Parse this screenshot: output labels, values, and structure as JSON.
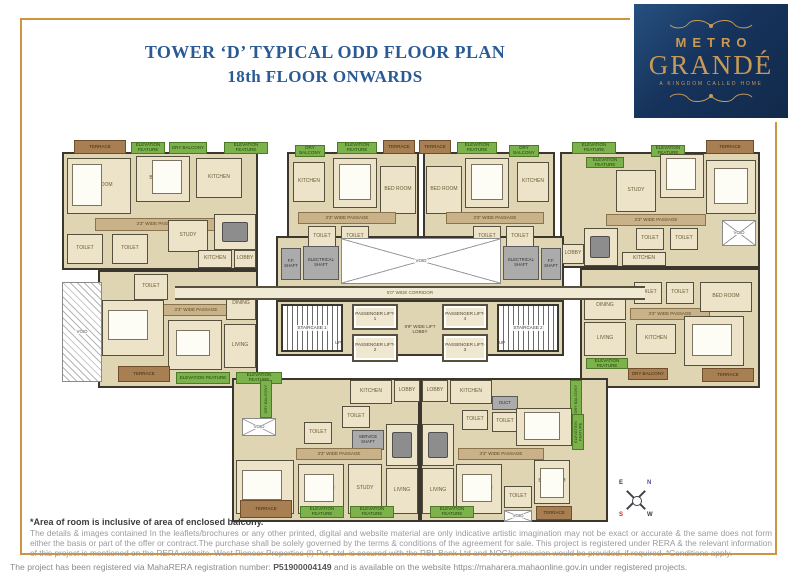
{
  "header": {
    "title_line1": "TOWER ‘D’ TYPICAL ODD FLOOR PLAN",
    "title_line2": "18th FLOOR ONWARDS"
  },
  "logo": {
    "line1": "METRO",
    "line2": "GRANDÉ",
    "tagline": "A KINGDOM CALLED HOME"
  },
  "colors": {
    "frame_gold": "#cf9442",
    "title_blue": "#2a5a94",
    "logo_navy": "#16335c",
    "logo_gold": "#c89a55",
    "room_beige": "#ece3c8",
    "passage_tan": "#c9b189",
    "terrace_brown": "#a87f52",
    "landscape_green": "#7cb24b",
    "wall_dark": "#3b372e"
  },
  "compass": {
    "n": "N",
    "e": "E",
    "s": "S",
    "w": "W"
  },
  "notes": {
    "bold": "*Area of room is inclusive of area of enclosed balcony.",
    "disclaimer": "The details & images contained In the leaflets/brochures or any other printed, digital and website material are only indicative artistic imagination may not be exact or accurate & the same does not form either the basis or part of the offer or contract.The purchase shall be solely governed by the terms & conditions of the agreement for sale. This project is registered under RERA & the relevant information of this project is mentioned on the RERA website. West Pioneer Properties (I) Pvt, Ltd. is secured with the RBL Bank Ltd and NOC/permission would be provided, if required. *Conditions apply."
  },
  "footer": {
    "prefix": "The project has been registered  via MahaRERA registration number: ",
    "reg_number": "P51900004149",
    "suffix": " and is available on the website https://maharera.mahaonline.gov.in under registered projects."
  },
  "plan": {
    "rooms": [
      {
        "t": "ol",
        "x": 62,
        "y": 152,
        "w": 196,
        "h": 118
      },
      {
        "t": "ol",
        "x": 98,
        "y": 270,
        "w": 160,
        "h": 118
      },
      {
        "t": "ol",
        "x": 287,
        "y": 152,
        "w": 132,
        "h": 94
      },
      {
        "t": "ol",
        "x": 423,
        "y": 152,
        "w": 132,
        "h": 94
      },
      {
        "t": "ol",
        "x": 560,
        "y": 152,
        "w": 200,
        "h": 116
      },
      {
        "t": "ol",
        "x": 580,
        "y": 268,
        "w": 180,
        "h": 120
      },
      {
        "t": "ol",
        "x": 232,
        "y": 378,
        "w": 188,
        "h": 144
      },
      {
        "t": "ol",
        "x": 420,
        "y": 378,
        "w": 188,
        "h": 144
      },
      {
        "t": "ol",
        "x": 276,
        "y": 236,
        "w": 288,
        "h": 64
      },
      {
        "t": "ol",
        "x": 276,
        "y": 300,
        "w": 288,
        "h": 56
      },
      {
        "t": "t",
        "l": "TERRACE",
        "x": 74,
        "y": 140,
        "w": 52,
        "h": 14
      },
      {
        "t": "g",
        "l": "ELEVATION FEATURE",
        "x": 131,
        "y": 142,
        "w": 34,
        "h": 12
      },
      {
        "t": "g",
        "l": "DRY BALCONY",
        "x": 169,
        "y": 142,
        "w": 38,
        "h": 12
      },
      {
        "t": "g",
        "l": "ELEVATION FEATURE",
        "x": 224,
        "y": 142,
        "w": 44,
        "h": 12
      },
      {
        "t": "g",
        "l": "DRY BALCONY",
        "x": 295,
        "y": 145,
        "w": 30,
        "h": 12
      },
      {
        "t": "g",
        "l": "ELEVATION FEATURE",
        "x": 337,
        "y": 142,
        "w": 40,
        "h": 12
      },
      {
        "t": "t",
        "l": "TERRACE",
        "x": 383,
        "y": 140,
        "w": 32,
        "h": 14
      },
      {
        "t": "t",
        "l": "TERRACE",
        "x": 419,
        "y": 140,
        "w": 32,
        "h": 14
      },
      {
        "t": "g",
        "l": "ELEVATION FEATURE",
        "x": 457,
        "y": 142,
        "w": 40,
        "h": 12
      },
      {
        "t": "g",
        "l": "DRY BALCONY",
        "x": 509,
        "y": 145,
        "w": 30,
        "h": 12
      },
      {
        "t": "g",
        "l": "ELEVATION FEATURE",
        "x": 572,
        "y": 142,
        "w": 44,
        "h": 12
      },
      {
        "t": "g",
        "l": "ELEVATION FEATURE",
        "x": 651,
        "y": 145,
        "w": 34,
        "h": 12
      },
      {
        "t": "t",
        "l": "TERRACE",
        "x": 706,
        "y": 140,
        "w": 48,
        "h": 14
      },
      {
        "t": "rm",
        "l": "BED ROOM",
        "x": 67,
        "y": 158,
        "w": 64,
        "h": 56
      },
      {
        "t": "bed",
        "x": 72,
        "y": 164,
        "w": 30,
        "h": 42
      },
      {
        "t": "rm",
        "l": "BED ROOM",
        "x": 136,
        "y": 156,
        "w": 54,
        "h": 46
      },
      {
        "t": "bed",
        "x": 152,
        "y": 160,
        "w": 30,
        "h": 34
      },
      {
        "t": "rm",
        "l": "KITCHEN",
        "x": 196,
        "y": 158,
        "w": 46,
        "h": 40
      },
      {
        "t": "p",
        "l": "3'3\" WIDE PASSAGE",
        "x": 95,
        "y": 218,
        "w": 126,
        "h": 13
      },
      {
        "t": "rm",
        "l": "TOILET",
        "x": 67,
        "y": 234,
        "w": 36,
        "h": 30
      },
      {
        "t": "rm",
        "l": "TOILET",
        "x": 112,
        "y": 234,
        "w": 36,
        "h": 30
      },
      {
        "t": "rm",
        "l": "STUDY",
        "x": 168,
        "y": 220,
        "w": 40,
        "h": 32
      },
      {
        "t": "rm",
        "l": "DINING",
        "x": 214,
        "y": 214,
        "w": 42,
        "h": 36
      },
      {
        "t": "tbl",
        "x": 222,
        "y": 222,
        "w": 26,
        "h": 20
      },
      {
        "t": "rm",
        "l": "KITCHEN",
        "x": 198,
        "y": 250,
        "w": 34,
        "h": 18
      },
      {
        "t": "rm",
        "l": "LOBBY",
        "x": 234,
        "y": 250,
        "w": 22,
        "h": 18
      },
      {
        "t": "vh",
        "l": "VOID",
        "x": 62,
        "y": 282,
        "w": 40,
        "h": 100
      },
      {
        "t": "rm",
        "l": "TOILET",
        "x": 134,
        "y": 274,
        "w": 34,
        "h": 26
      },
      {
        "t": "p",
        "l": "3'3\" WIDE PASSAGE",
        "x": 150,
        "y": 304,
        "w": 92,
        "h": 12
      },
      {
        "t": "rm",
        "l": "BED ROOM",
        "x": 102,
        "y": 300,
        "w": 62,
        "h": 56
      },
      {
        "t": "bed",
        "x": 108,
        "y": 310,
        "w": 40,
        "h": 30
      },
      {
        "t": "rm",
        "l": "BED ROOM",
        "x": 168,
        "y": 320,
        "w": 54,
        "h": 50
      },
      {
        "t": "bed",
        "x": 176,
        "y": 330,
        "w": 34,
        "h": 26
      },
      {
        "t": "rm",
        "l": "DINING",
        "x": 226,
        "y": 288,
        "w": 30,
        "h": 32
      },
      {
        "t": "rm",
        "l": "LIVING",
        "x": 224,
        "y": 324,
        "w": 32,
        "h": 44
      },
      {
        "t": "t",
        "l": "TERRACE",
        "x": 118,
        "y": 366,
        "w": 52,
        "h": 16
      },
      {
        "t": "g",
        "l": "ELEVATION FEATURE",
        "x": 176,
        "y": 372,
        "w": 54,
        "h": 12
      },
      {
        "t": "g",
        "l": "ELEVATION FEATURE",
        "x": 236,
        "y": 372,
        "w": 46,
        "h": 12
      },
      {
        "t": "rm",
        "l": "KITCHEN",
        "x": 293,
        "y": 162,
        "w": 32,
        "h": 40
      },
      {
        "t": "rm",
        "l": "BED ROOM",
        "x": 333,
        "y": 158,
        "w": 44,
        "h": 50
      },
      {
        "t": "bed",
        "x": 339,
        "y": 164,
        "w": 32,
        "h": 36
      },
      {
        "t": "rm",
        "l": "BED ROOM",
        "x": 380,
        "y": 166,
        "w": 36,
        "h": 48
      },
      {
        "t": "p",
        "l": "3'3\" WIDE PASSAGE",
        "x": 298,
        "y": 212,
        "w": 98,
        "h": 12
      },
      {
        "t": "rm",
        "l": "TOILET",
        "x": 308,
        "y": 226,
        "w": 28,
        "h": 22
      },
      {
        "t": "rm",
        "l": "TOILET",
        "x": 341,
        "y": 226,
        "w": 28,
        "h": 22
      },
      {
        "t": "rm",
        "l": "BED ROOM",
        "x": 426,
        "y": 166,
        "w": 36,
        "h": 48
      },
      {
        "t": "rm",
        "l": "BED ROOM",
        "x": 465,
        "y": 158,
        "w": 44,
        "h": 50
      },
      {
        "t": "bed",
        "x": 471,
        "y": 164,
        "w": 32,
        "h": 36
      },
      {
        "t": "rm",
        "l": "KITCHEN",
        "x": 517,
        "y": 162,
        "w": 32,
        "h": 40
      },
      {
        "t": "p",
        "l": "3'3\" WIDE PASSAGE",
        "x": 446,
        "y": 212,
        "w": 98,
        "h": 12
      },
      {
        "t": "rm",
        "l": "TOILET",
        "x": 473,
        "y": 226,
        "w": 28,
        "h": 22
      },
      {
        "t": "rm",
        "l": "TOILET",
        "x": 506,
        "y": 226,
        "w": 28,
        "h": 22
      },
      {
        "t": "g",
        "l": "ELEVATION FEATURE",
        "x": 586,
        "y": 157,
        "w": 38,
        "h": 11
      },
      {
        "t": "rm",
        "l": "STUDY",
        "x": 616,
        "y": 170,
        "w": 40,
        "h": 42
      },
      {
        "t": "rm",
        "l": "BED ROOM",
        "x": 660,
        "y": 154,
        "w": 44,
        "h": 44
      },
      {
        "t": "bed",
        "x": 666,
        "y": 158,
        "w": 30,
        "h": 32
      },
      {
        "t": "rm",
        "l": "BED ROOM",
        "x": 706,
        "y": 160,
        "w": 50,
        "h": 54
      },
      {
        "t": "bed",
        "x": 714,
        "y": 168,
        "w": 34,
        "h": 36
      },
      {
        "t": "p",
        "l": "3'3\" WIDE PASSAGE",
        "x": 606,
        "y": 214,
        "w": 100,
        "h": 12
      },
      {
        "t": "rm",
        "l": "DINING",
        "x": 584,
        "y": 228,
        "w": 34,
        "h": 38
      },
      {
        "t": "tbl",
        "x": 590,
        "y": 236,
        "w": 20,
        "h": 22
      },
      {
        "t": "rm",
        "l": "TOILET",
        "x": 636,
        "y": 228,
        "w": 28,
        "h": 22
      },
      {
        "t": "rm",
        "l": "TOILET",
        "x": 670,
        "y": 228,
        "w": 28,
        "h": 22
      },
      {
        "t": "v",
        "l": "VOID",
        "x": 722,
        "y": 220,
        "w": 34,
        "h": 26
      },
      {
        "t": "rm",
        "l": "LOBBY",
        "x": 562,
        "y": 244,
        "w": 22,
        "h": 20
      },
      {
        "t": "rm",
        "l": "KITCHEN",
        "x": 622,
        "y": 252,
        "w": 44,
        "h": 14
      },
      {
        "t": "rm",
        "l": "DINING",
        "x": 584,
        "y": 292,
        "w": 42,
        "h": 28
      },
      {
        "t": "rm",
        "l": "LIVING",
        "x": 584,
        "y": 322,
        "w": 42,
        "h": 34
      },
      {
        "t": "g",
        "l": "ELEVATION FEATURE",
        "x": 586,
        "y": 358,
        "w": 42,
        "h": 11
      },
      {
        "t": "rm",
        "l": "TOILET",
        "x": 634,
        "y": 282,
        "w": 28,
        "h": 22
      },
      {
        "t": "rm",
        "l": "TOILET",
        "x": 666,
        "y": 282,
        "w": 28,
        "h": 22
      },
      {
        "t": "p",
        "l": "3'3\" WIDE PASSAGE",
        "x": 630,
        "y": 308,
        "w": 80,
        "h": 12
      },
      {
        "t": "rm",
        "l": "KITCHEN",
        "x": 636,
        "y": 324,
        "w": 40,
        "h": 30
      },
      {
        "t": "rm",
        "l": "BED ROOM",
        "x": 684,
        "y": 316,
        "w": 60,
        "h": 50
      },
      {
        "t": "bed",
        "x": 692,
        "y": 324,
        "w": 40,
        "h": 32
      },
      {
        "t": "rm",
        "l": "BED ROOM",
        "x": 700,
        "y": 282,
        "w": 52,
        "h": 30
      },
      {
        "t": "t",
        "l": "DRY BALCONY",
        "x": 628,
        "y": 368,
        "w": 40,
        "h": 12
      },
      {
        "t": "t",
        "l": "TERRACE",
        "x": 702,
        "y": 368,
        "w": 52,
        "h": 14
      },
      {
        "t": "sh",
        "l": "F.F. SHAFT",
        "x": 281,
        "y": 248,
        "w": 20,
        "h": 32
      },
      {
        "t": "sh",
        "l": "ELECTRICAL SHAFT",
        "x": 303,
        "y": 246,
        "w": 36,
        "h": 34
      },
      {
        "t": "v",
        "l": "VOID",
        "x": 341,
        "y": 238,
        "w": 160,
        "h": 46
      },
      {
        "t": "sh",
        "l": "ELECTRICAL SHAFT",
        "x": 503,
        "y": 246,
        "w": 36,
        "h": 34
      },
      {
        "t": "sh",
        "l": "F.F. SHAFT",
        "x": 541,
        "y": 248,
        "w": 20,
        "h": 32
      },
      {
        "t": "cor",
        "l": "5'0\" WIDE CORRIDOR",
        "x": 175,
        "y": 286,
        "w": 470,
        "h": 14
      },
      {
        "t": "st",
        "l": "STAIRCASE 1",
        "x": 281,
        "y": 304,
        "w": 62,
        "h": 48
      },
      {
        "t": "lbl",
        "l": "UP",
        "x": 330,
        "y": 338,
        "w": 16,
        "h": 10
      },
      {
        "t": "lf",
        "l": "PASSENGER LIFT-1",
        "x": 352,
        "y": 304,
        "w": 46,
        "h": 26
      },
      {
        "t": "lf",
        "l": "PASSENGER LIFT-2",
        "x": 352,
        "y": 334,
        "w": 46,
        "h": 28
      },
      {
        "t": "lbl",
        "l": "9'9\" WIDE LIFT LOBBY",
        "x": 400,
        "y": 316,
        "w": 40,
        "h": 28
      },
      {
        "t": "lf",
        "l": "PASSENGER LIFT-4",
        "x": 442,
        "y": 304,
        "w": 46,
        "h": 26
      },
      {
        "t": "lf",
        "l": "PASSENGER LIFT-3",
        "x": 442,
        "y": 334,
        "w": 46,
        "h": 28
      },
      {
        "t": "st",
        "l": "STAIRCASE 2",
        "x": 497,
        "y": 304,
        "w": 62,
        "h": 48
      },
      {
        "t": "lbl",
        "l": "UP",
        "x": 494,
        "y": 338,
        "w": 16,
        "h": 10
      },
      {
        "t": "g",
        "l": "DRY BALCONY",
        "x": 260,
        "y": 380,
        "w": 12,
        "h": 38,
        "v": 1
      },
      {
        "t": "rm",
        "l": "KITCHEN",
        "x": 350,
        "y": 380,
        "w": 42,
        "h": 24
      },
      {
        "t": "rm",
        "l": "LOBBY",
        "x": 394,
        "y": 380,
        "w": 26,
        "h": 22
      },
      {
        "t": "rm",
        "l": "LOBBY",
        "x": 422,
        "y": 380,
        "w": 26,
        "h": 22
      },
      {
        "t": "rm",
        "l": "KITCHEN",
        "x": 450,
        "y": 380,
        "w": 42,
        "h": 24
      },
      {
        "t": "g",
        "l": "DRY BALCONY",
        "x": 570,
        "y": 380,
        "w": 12,
        "h": 38,
        "v": 1
      },
      {
        "t": "v",
        "l": "VOID",
        "x": 242,
        "y": 418,
        "w": 34,
        "h": 18
      },
      {
        "t": "rm",
        "l": "TOILET",
        "x": 304,
        "y": 422,
        "w": 28,
        "h": 22
      },
      {
        "t": "rm",
        "l": "TOILET",
        "x": 342,
        "y": 406,
        "w": 28,
        "h": 22
      },
      {
        "t": "sh",
        "l": "SERVICE SHAFT",
        "x": 352,
        "y": 430,
        "w": 32,
        "h": 20
      },
      {
        "t": "rm",
        "l": "DINING",
        "x": 386,
        "y": 424,
        "w": 32,
        "h": 42
      },
      {
        "t": "tbl",
        "x": 392,
        "y": 432,
        "w": 20,
        "h": 26
      },
      {
        "t": "rm",
        "l": "LIVING",
        "x": 386,
        "y": 468,
        "w": 32,
        "h": 46
      },
      {
        "t": "p",
        "l": "3'3\" WIDE PASSAGE",
        "x": 296,
        "y": 448,
        "w": 86,
        "h": 12
      },
      {
        "t": "rm",
        "l": "BED ROOM",
        "x": 236,
        "y": 460,
        "w": 58,
        "h": 54
      },
      {
        "t": "bed",
        "x": 242,
        "y": 470,
        "w": 40,
        "h": 30
      },
      {
        "t": "rm",
        "l": "BED ROOM",
        "x": 298,
        "y": 464,
        "w": 46,
        "h": 50
      },
      {
        "t": "bed",
        "x": 304,
        "y": 474,
        "w": 30,
        "h": 28
      },
      {
        "t": "rm",
        "l": "STUDY",
        "x": 348,
        "y": 464,
        "w": 34,
        "h": 50
      },
      {
        "t": "t",
        "l": "TERRACE",
        "x": 240,
        "y": 500,
        "w": 52,
        "h": 18
      },
      {
        "t": "g",
        "l": "ELEVATION FEATURE",
        "x": 300,
        "y": 506,
        "w": 44,
        "h": 12
      },
      {
        "t": "g",
        "l": "ELEVATION FEATURE",
        "x": 350,
        "y": 506,
        "w": 44,
        "h": 12
      },
      {
        "t": "rm",
        "l": "DINING",
        "x": 422,
        "y": 424,
        "w": 32,
        "h": 42
      },
      {
        "t": "tbl",
        "x": 428,
        "y": 432,
        "w": 20,
        "h": 26
      },
      {
        "t": "rm",
        "l": "LIVING",
        "x": 422,
        "y": 468,
        "w": 32,
        "h": 46
      },
      {
        "t": "sh",
        "l": "DUCT",
        "x": 492,
        "y": 396,
        "w": 26,
        "h": 14
      },
      {
        "t": "rm",
        "l": "TOILET",
        "x": 462,
        "y": 410,
        "w": 26,
        "h": 20
      },
      {
        "t": "rm",
        "l": "TOILET",
        "x": 492,
        "y": 412,
        "w": 26,
        "h": 20
      },
      {
        "t": "rm",
        "l": "BED ROOM",
        "x": 516,
        "y": 408,
        "w": 56,
        "h": 38
      },
      {
        "t": "bed",
        "x": 524,
        "y": 412,
        "w": 36,
        "h": 28
      },
      {
        "t": "p",
        "l": "3'3\" WIDE PASSAGE",
        "x": 458,
        "y": 448,
        "w": 86,
        "h": 12
      },
      {
        "t": "rm",
        "l": "BED ROOM",
        "x": 456,
        "y": 464,
        "w": 46,
        "h": 50
      },
      {
        "t": "bed",
        "x": 462,
        "y": 474,
        "w": 30,
        "h": 28
      },
      {
        "t": "rm",
        "l": "TOILET",
        "x": 504,
        "y": 486,
        "w": 28,
        "h": 22
      },
      {
        "t": "rm",
        "l": "BED ROOM",
        "x": 534,
        "y": 460,
        "w": 36,
        "h": 44
      },
      {
        "t": "bed",
        "x": 540,
        "y": 468,
        "w": 24,
        "h": 30
      },
      {
        "t": "v",
        "l": "VOID",
        "x": 504,
        "y": 510,
        "w": 28,
        "h": 12
      },
      {
        "t": "t",
        "l": "TERRACE",
        "x": 536,
        "y": 506,
        "w": 36,
        "h": 14
      },
      {
        "t": "g",
        "l": "ELEVATION FEATURE",
        "x": 430,
        "y": 506,
        "w": 44,
        "h": 12
      },
      {
        "t": "g",
        "l": "ELEVATION FEATURE",
        "x": 572,
        "y": 414,
        "w": 12,
        "h": 36,
        "v": 1
      }
    ]
  }
}
